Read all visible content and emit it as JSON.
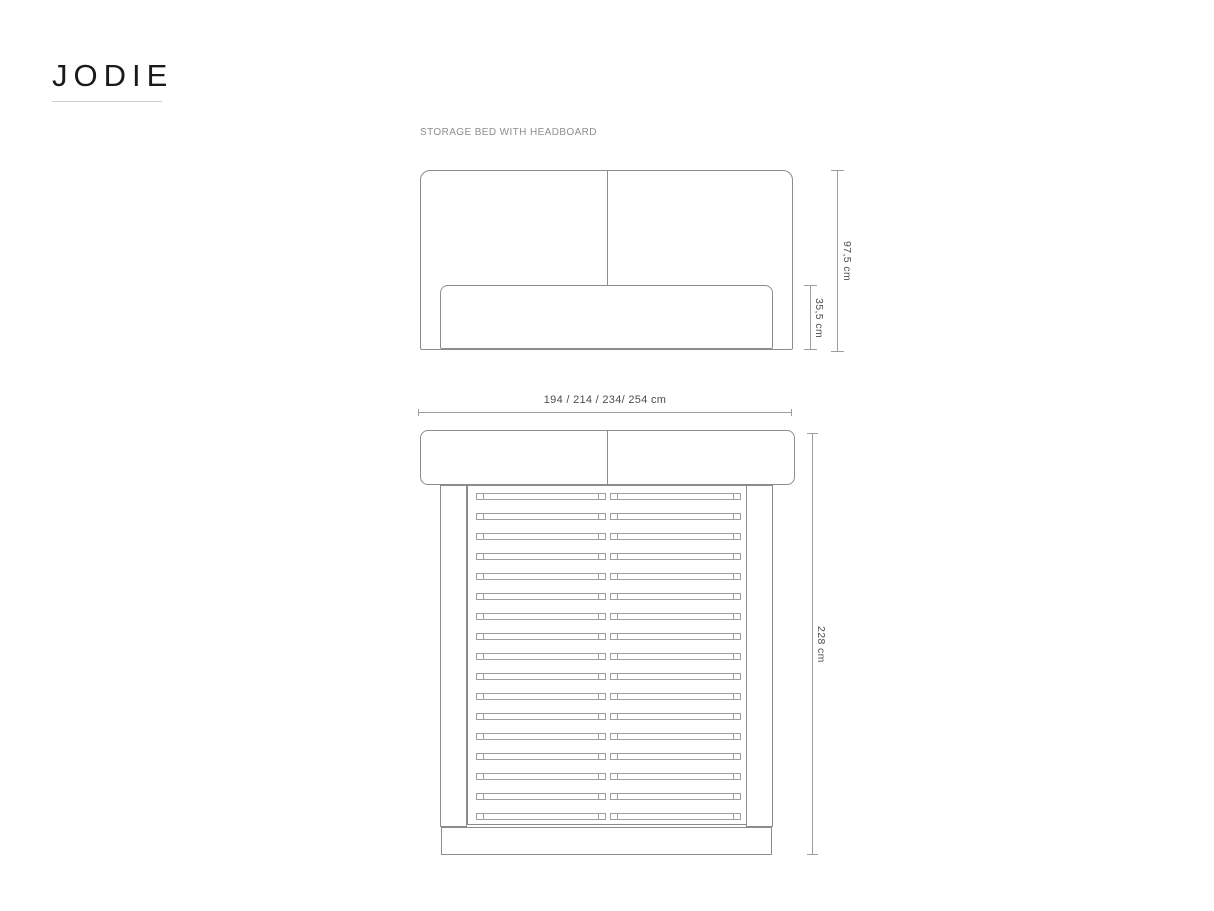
{
  "brand": {
    "logo": "JODIE"
  },
  "product": {
    "label": "STORAGE BED WITH HEADBOARD"
  },
  "front_view": {
    "description": "front elevation of storage bed with two-panel headboard and bed base",
    "dim_total_height": "97,5 cm",
    "dim_base_height": "35,5 cm"
  },
  "width_dimension": {
    "label": "194 / 214 / 234/ 254 cm"
  },
  "top_view": {
    "description": "top plan of storage bed showing headboard cushions, side rails, slats and footboard",
    "dim_length": "228 cm",
    "slat_rows": 17
  },
  "colors": {
    "outline": "#8c8c8c",
    "dimension_line": "#9e9e9e",
    "dimension_text": "#4d4d4d",
    "label_text": "#8d8d8d",
    "logo_text": "#1a1a1a",
    "underline": "#cfcfcf"
  }
}
